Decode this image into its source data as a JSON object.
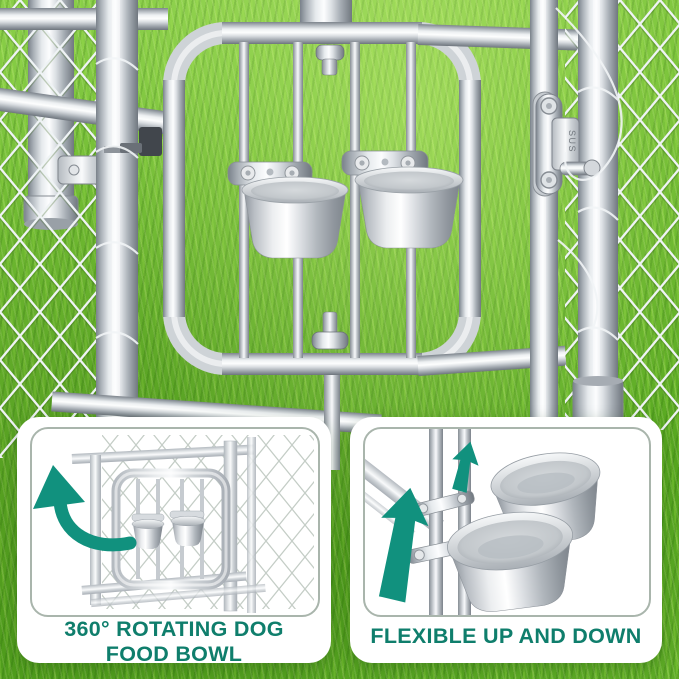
{
  "scene": {
    "latch_label": "SUS"
  },
  "panels": {
    "left": {
      "caption_line1": "360° ROTATING DOG",
      "caption_line2": "FOOD BOWL"
    },
    "right": {
      "caption": "FLEXIBLE UP AND DOWN"
    }
  },
  "colors": {
    "caption_teal": "#0F7E6C",
    "arrow_teal": "#11917E",
    "card_bg": "#FFFFFF",
    "illo_border": "#A9B5AC",
    "grass_light": "#8BCF4A",
    "grass_dark": "#55A51F",
    "metal_light": "#F4F6F8",
    "metal_dark": "#7A8189"
  }
}
